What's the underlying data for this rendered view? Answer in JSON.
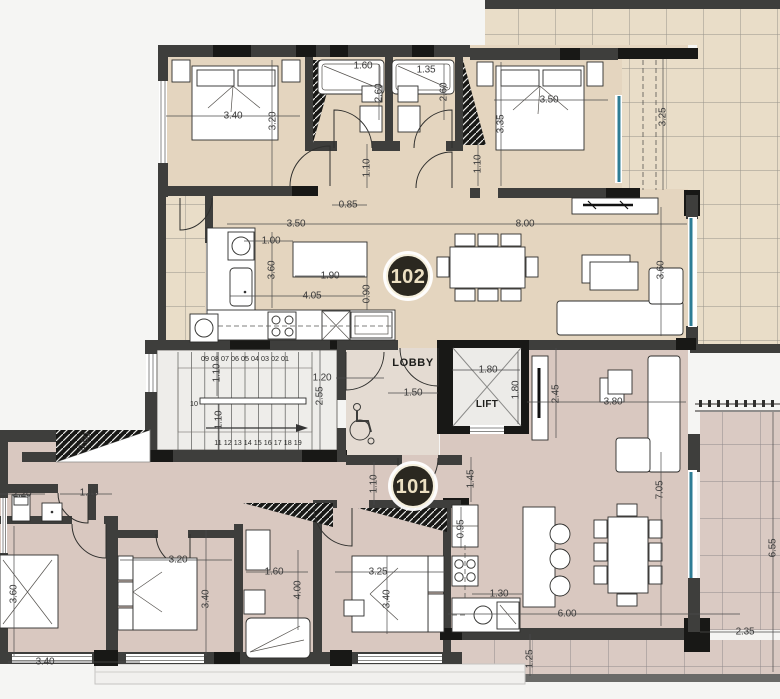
{
  "drawing": {
    "unit_102_label": "102",
    "unit_101_label": "101",
    "lobby_label": "LOBBY",
    "lift_label": "LIFT",
    "stairs": {
      "flight1_numbers": "09 08 07 06 05 04 03 02 01",
      "landing_number": "10",
      "flight2_numbers": "11 12 13 14 15 16 17 18 19"
    },
    "colors": {
      "floor_102": "#e4d5bf",
      "floor_101": "#d9c8c0",
      "terrace_102": "#e9ddc8",
      "terrace_101": "#dacac3",
      "wall": "#3e3e3c",
      "wall_black": "#181816",
      "glass": "#2e7d95",
      "stair_floor": "#eeedea",
      "lobby_floor": "#e4dbd2",
      "label_circle": "#2b2820",
      "label_text": "#ece0c2",
      "dim_text": "#3b3b3b",
      "background": "#f5f5f3"
    },
    "dimensions": [
      {
        "text": "3.40",
        "x": 233,
        "y": 116,
        "r": 0
      },
      {
        "text": "3.20",
        "x": 273,
        "y": 121,
        "r": -90
      },
      {
        "text": "1.60",
        "x": 363,
        "y": 66,
        "r": 0
      },
      {
        "text": "1.35",
        "x": 426,
        "y": 70,
        "r": 0
      },
      {
        "text": "2.60",
        "x": 379,
        "y": 93,
        "r": -90
      },
      {
        "text": "2.60",
        "x": 444,
        "y": 92,
        "r": -90
      },
      {
        "text": "3.50",
        "x": 549,
        "y": 100,
        "r": 0
      },
      {
        "text": "3.35",
        "x": 501,
        "y": 124,
        "r": -90
      },
      {
        "text": "3.25",
        "x": 663,
        "y": 117,
        "r": -90
      },
      {
        "text": "1.10",
        "x": 367,
        "y": 168,
        "r": -90
      },
      {
        "text": "1.10",
        "x": 478,
        "y": 164,
        "r": -90
      },
      {
        "text": "0.85",
        "x": 348,
        "y": 205,
        "r": 0
      },
      {
        "text": "3.50",
        "x": 296,
        "y": 224,
        "r": 0
      },
      {
        "text": "8.00",
        "x": 525,
        "y": 224,
        "r": 0
      },
      {
        "text": "1.00",
        "x": 271,
        "y": 241,
        "r": 0
      },
      {
        "text": "3.60",
        "x": 272,
        "y": 270,
        "r": -90
      },
      {
        "text": "1.90",
        "x": 330,
        "y": 276,
        "r": 0
      },
      {
        "text": "4.05",
        "x": 312,
        "y": 296,
        "r": 0
      },
      {
        "text": "0.90",
        "x": 367,
        "y": 294,
        "r": -90
      },
      {
        "text": "3.60",
        "x": 661,
        "y": 270,
        "r": -90
      },
      {
        "text": "1.10",
        "x": 217,
        "y": 373,
        "r": -90
      },
      {
        "text": "1.10",
        "x": 219,
        "y": 420,
        "r": -90
      },
      {
        "text": "1.20",
        "x": 322,
        "y": 378,
        "r": 0
      },
      {
        "text": "2.55",
        "x": 320,
        "y": 396,
        "r": -90
      },
      {
        "text": "1.50",
        "x": 413,
        "y": 393,
        "r": 0
      },
      {
        "text": "1.80",
        "x": 488,
        "y": 370,
        "r": 0
      },
      {
        "text": "1.80",
        "x": 516,
        "y": 390,
        "r": -90
      },
      {
        "text": "2.45",
        "x": 556,
        "y": 394,
        "r": -90
      },
      {
        "text": "3.80",
        "x": 613,
        "y": 402,
        "r": 0
      },
      {
        "text": "1.45",
        "x": 471,
        "y": 479,
        "r": -90
      },
      {
        "text": "1.10",
        "x": 374,
        "y": 484,
        "r": -90
      },
      {
        "text": "7.05",
        "x": 660,
        "y": 490,
        "r": -90
      },
      {
        "text": "2.20",
        "x": 22,
        "y": 494,
        "r": 0
      },
      {
        "text": "1.10",
        "x": 89,
        "y": 493,
        "r": 0
      },
      {
        "text": "0.60",
        "x": 85,
        "y": 442,
        "r": -68
      },
      {
        "text": "3.60",
        "x": 14,
        "y": 594,
        "r": -90
      },
      {
        "text": "3.40",
        "x": 45,
        "y": 662,
        "r": 0
      },
      {
        "text": "3.20",
        "x": 178,
        "y": 560,
        "r": 0
      },
      {
        "text": "3.40",
        "x": 206,
        "y": 599,
        "r": -90
      },
      {
        "text": "1.60",
        "x": 274,
        "y": 572,
        "r": 0
      },
      {
        "text": "4.00",
        "x": 298,
        "y": 590,
        "r": -90
      },
      {
        "text": "3.25",
        "x": 378,
        "y": 572,
        "r": 0
      },
      {
        "text": "3.40",
        "x": 387,
        "y": 599,
        "r": -90
      },
      {
        "text": "0.95",
        "x": 461,
        "y": 529,
        "r": -90
      },
      {
        "text": "1.30",
        "x": 499,
        "y": 594,
        "r": 0
      },
      {
        "text": "6.00",
        "x": 567,
        "y": 614,
        "r": 0
      },
      {
        "text": "1.25",
        "x": 530,
        "y": 659,
        "r": -90
      },
      {
        "text": "2.35",
        "x": 745,
        "y": 632,
        "r": 0
      },
      {
        "text": "6.55",
        "x": 773,
        "y": 548,
        "r": -90
      }
    ]
  }
}
